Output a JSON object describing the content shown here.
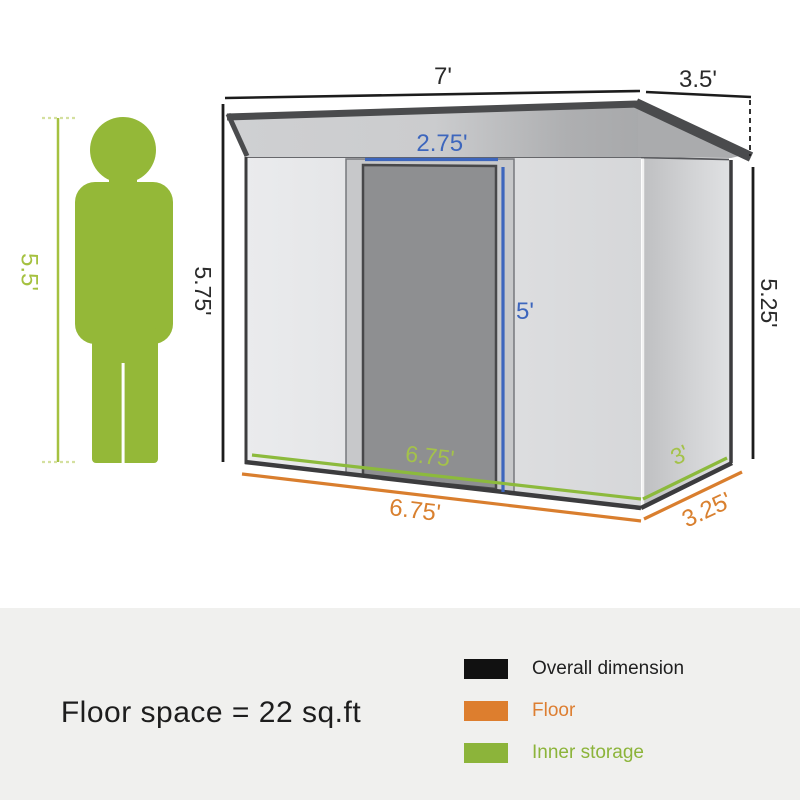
{
  "diagram": {
    "labels": {
      "roof_width": "7'",
      "roof_depth": "3.5'",
      "left_height": "5.75'",
      "right_height": "5.25'",
      "door_width": "2.75'",
      "door_height": "5'",
      "inner_length": "6.75'",
      "inner_depth": "3'",
      "floor_length": "6.75'",
      "floor_depth": "3.25'",
      "person_height": "5.5'"
    },
    "colors": {
      "overall_dimension": "#111111",
      "floor": "#dd7e2e",
      "inner_storage": "#8cb43a",
      "door_dimension_blue": "#3d66bd",
      "person_green": "#94b838",
      "roof_dark": "#4a4b4d",
      "panel_background": "#f0f0ee"
    }
  },
  "footer": {
    "floor_space": "Floor space = 22 sq.ft",
    "legend": [
      {
        "label": "Overall dimension",
        "color": "#111111"
      },
      {
        "label": "Floor",
        "color": "#dd7e2e"
      },
      {
        "label": "Inner storage",
        "color": "#8cb43a"
      }
    ]
  }
}
